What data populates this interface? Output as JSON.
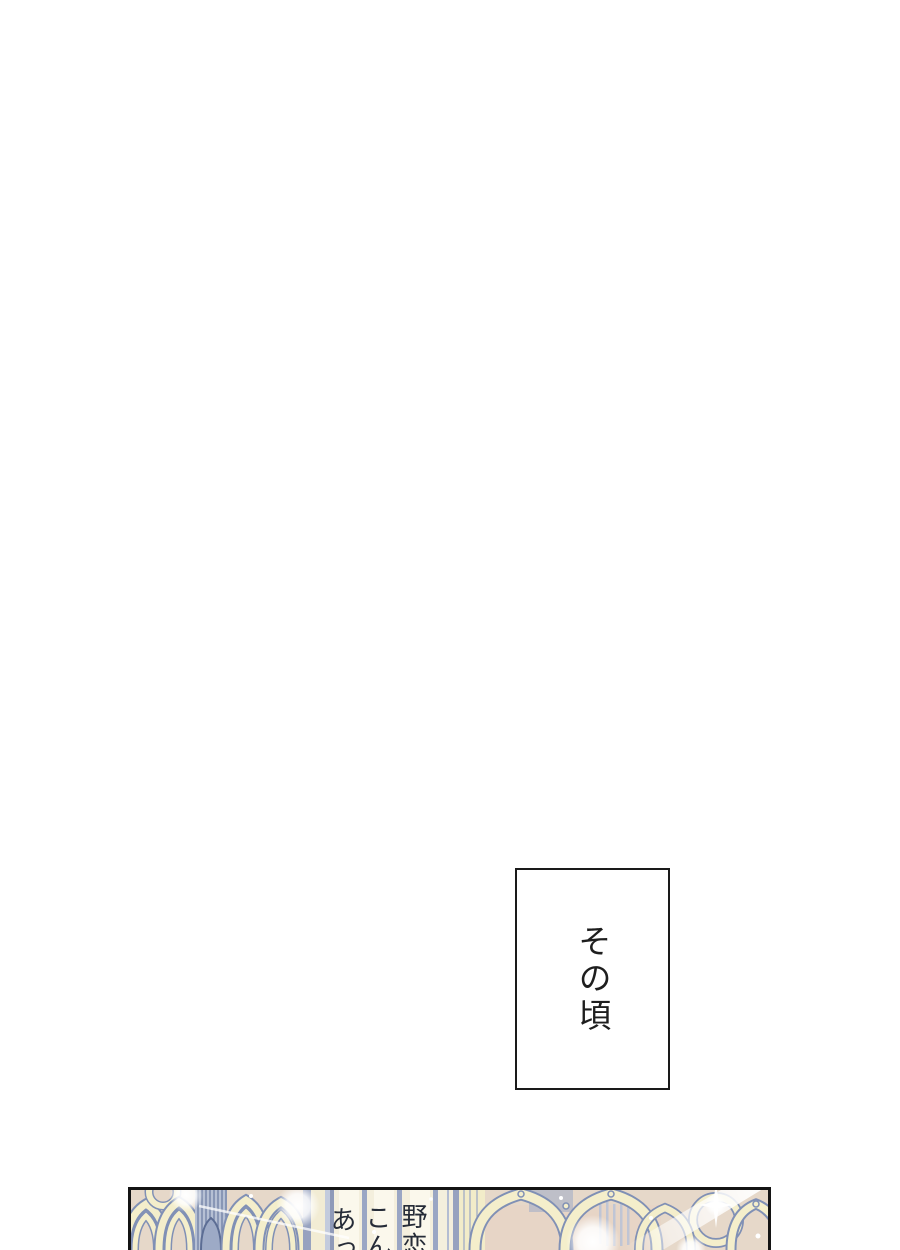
{
  "caption": {
    "text": "その頃",
    "border_color": "#1a1a1a",
    "text_color": "#1e1e1e"
  },
  "panel": {
    "speech_columns": [
      "野恋",
      "こん",
      "あっ"
    ],
    "colors": {
      "panel_border": "#141414",
      "base_tan": "#e6d8c9",
      "arch_cream": "#f4eecb",
      "outline_blue": "#8090b5",
      "stripe_blue": "#9aa6c4",
      "hatch_blue": "#b6c0d4",
      "speech_text": "#262c38",
      "sparkle": "#ffffff"
    }
  },
  "page": {
    "background": "#ffffff"
  }
}
